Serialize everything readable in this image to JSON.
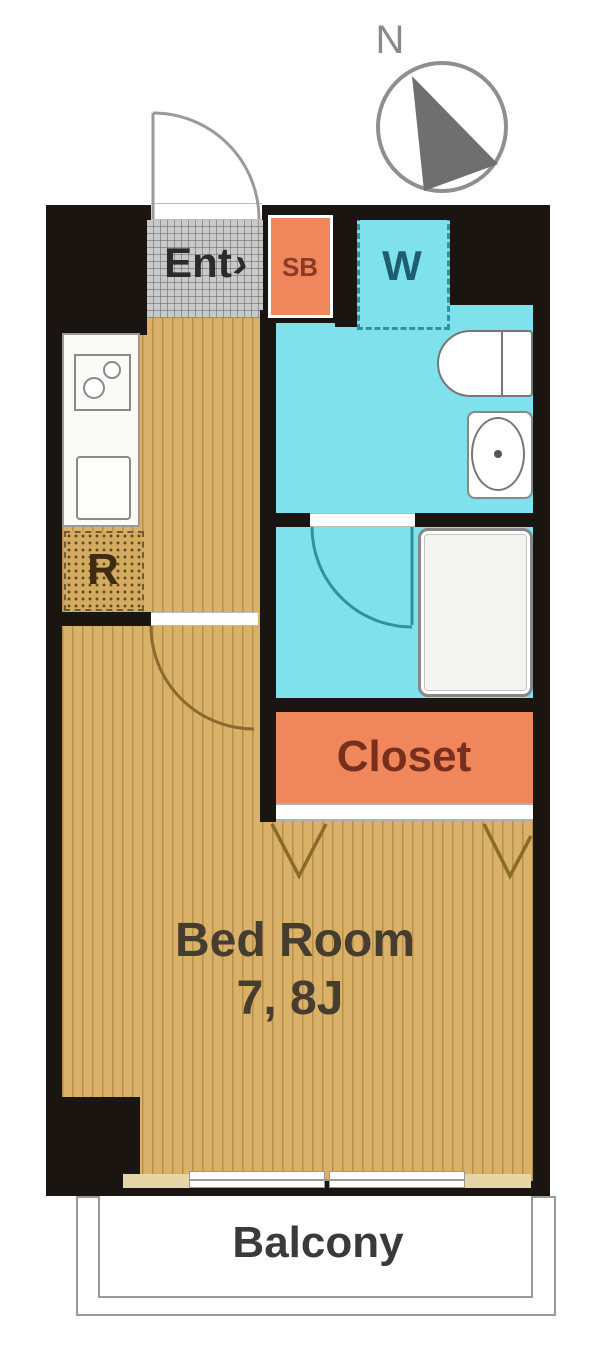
{
  "labels": {
    "compass_north": "N",
    "entrance": "Ent",
    "entrance_arrow": "›",
    "shoe_box": "SB",
    "washing_machine": "W",
    "refrigerator": "R",
    "closet": "Closet",
    "bedroom_name": "Bed Room",
    "bedroom_size": "7, 8J",
    "balcony": "Balcony"
  },
  "colors": {
    "wall_black": "#1a1511",
    "wood_floor": "#d9b169",
    "wood_floor_stripe": "#926824",
    "wet_area_cyan": "#7fe1ec",
    "closet_orange": "#f0875c",
    "entrance_tile_gray": "#c9c9c9",
    "bedroom_label": "#463c30",
    "closet_label": "#7a2f1c",
    "shoe_box_label": "#8c3a26",
    "washing_machine_label": "#1d5f70",
    "refrigerator_label": "#3f2c10",
    "balcony_label": "#3a3a3a",
    "compass_gray": "#8a8a8a",
    "door_arc_wood": "#8a6a30",
    "door_arc_bath": "#2d93a3"
  }
}
